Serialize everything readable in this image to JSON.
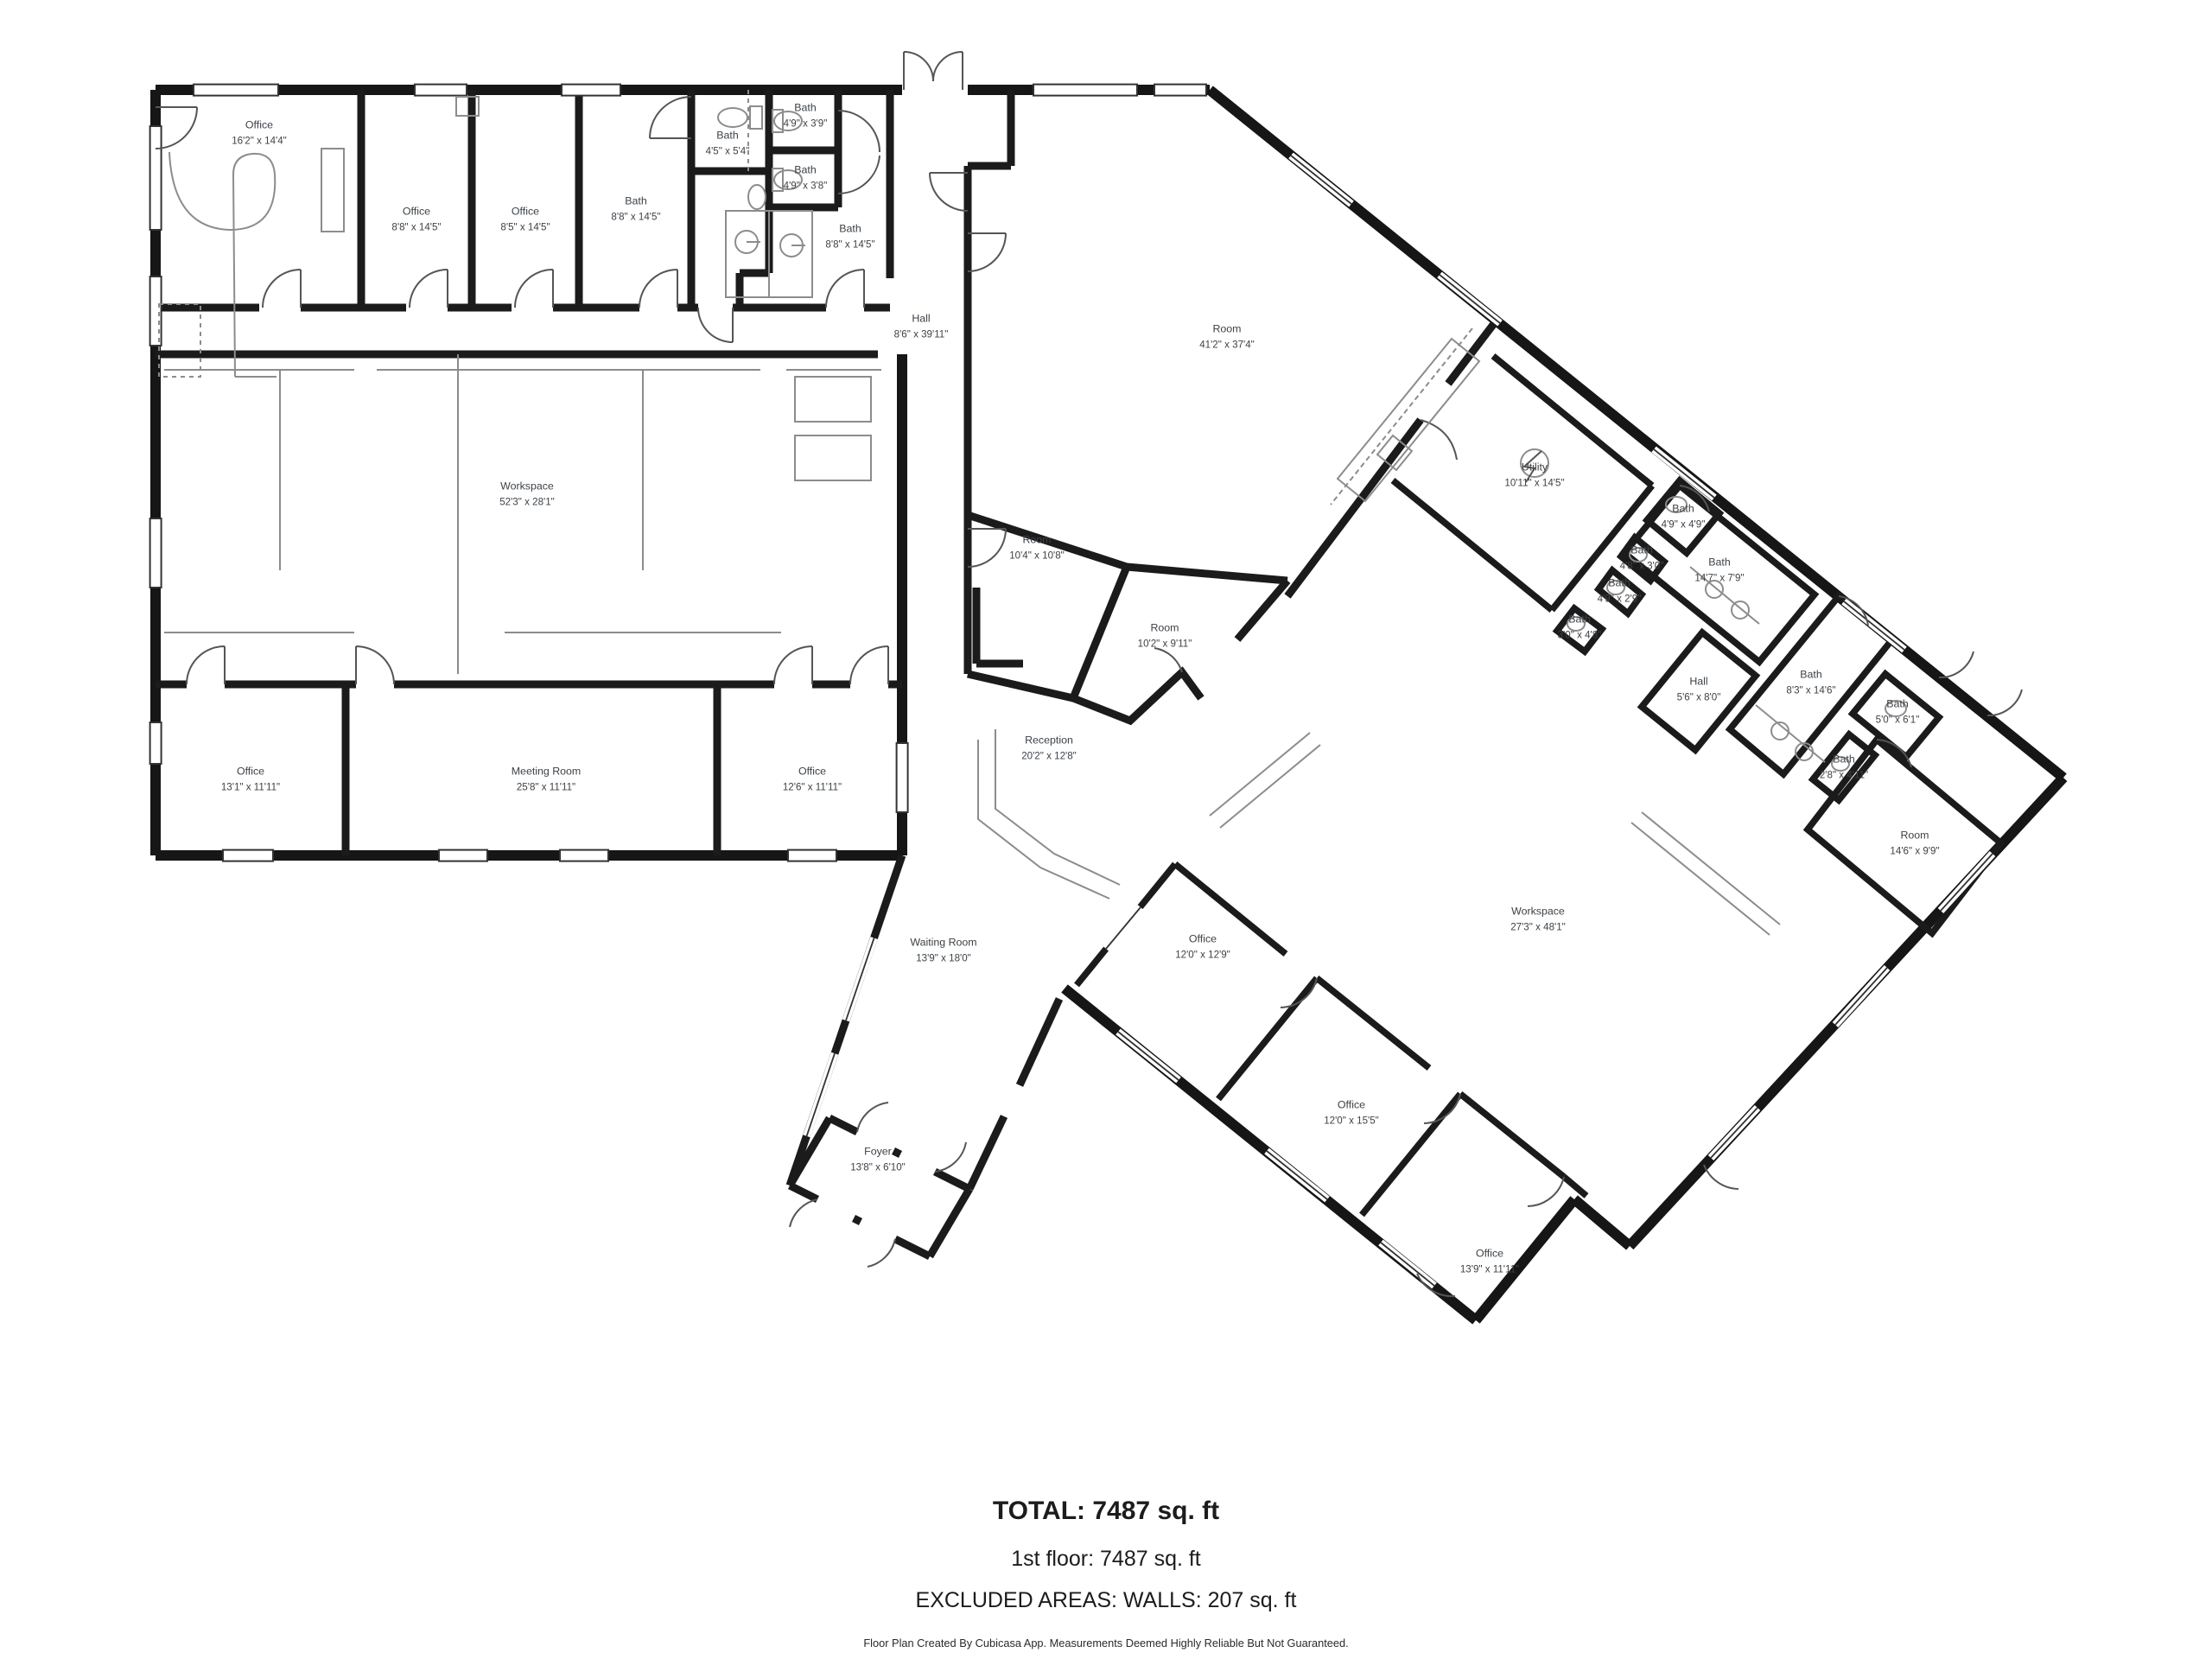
{
  "plan": {
    "type": "floor-plan",
    "source_app_note": "Floor Plan Created By Cubicasa App. Measurements Deemed Highly Reliable But Not Guaranteed.",
    "totals": {
      "total": "TOTAL: 7487 sq. ft",
      "first_floor": "1st floor: 7487 sq. ft",
      "excluded": "EXCLUDED AREAS: WALLS: 207 sq. ft"
    },
    "colors": {
      "walls": "#161616",
      "fixtures": "#8c8c8c",
      "label_text": "#3d4247",
      "background": "#ffffff"
    }
  },
  "rooms": [
    {
      "name": "Office",
      "dims": "16'2\" x 14'4\""
    },
    {
      "name": "Office",
      "dims": "8'8\" x 14'5\""
    },
    {
      "name": "Office",
      "dims": "8'5\" x 14'5\""
    },
    {
      "name": "Bath",
      "dims": "8'8\" x 14'5\""
    },
    {
      "name": "Bath",
      "dims": "4'5\" x 5'4\""
    },
    {
      "name": "Bath",
      "dims": "4'9\" x 3'9\""
    },
    {
      "name": "Bath",
      "dims": "4'9\" x 3'8\""
    },
    {
      "name": "Bath",
      "dims": "8'8\" x 14'5\""
    },
    {
      "name": "Hall",
      "dims": "8'6\" x 39'11\""
    },
    {
      "name": "Room",
      "dims": "41'2\" x 37'4\""
    },
    {
      "name": "Workspace",
      "dims": "52'3\" x 28'1\""
    },
    {
      "name": "Room",
      "dims": "10'4\" x 10'8\""
    },
    {
      "name": "Room",
      "dims": "10'2\" x 9'11\""
    },
    {
      "name": "Utility",
      "dims": "10'11\" x 14'5\""
    },
    {
      "name": "Bath",
      "dims": "4'9\" x 4'9\""
    },
    {
      "name": "Bath",
      "dims": "4'8\" x 3'0\""
    },
    {
      "name": "Bath",
      "dims": "4'9\" x 2'9\""
    },
    {
      "name": "Bath",
      "dims": "3'0\" x 4'8\""
    },
    {
      "name": "Bath",
      "dims": "14'7\" x 7'9\""
    },
    {
      "name": "Hall",
      "dims": "5'6\" x 8'0\""
    },
    {
      "name": "Bath",
      "dims": "8'3\" x 14'6\""
    },
    {
      "name": "Bath",
      "dims": "5'0\" x 6'1\""
    },
    {
      "name": "Bath",
      "dims": "2'8\" x 4'11\""
    },
    {
      "name": "Room",
      "dims": "14'6\" x 9'9\""
    },
    {
      "name": "Reception",
      "dims": "20'2\" x 12'8\""
    },
    {
      "name": "Office",
      "dims": "13'1\" x 11'11\""
    },
    {
      "name": "Meeting Room",
      "dims": "25'8\" x 11'11\""
    },
    {
      "name": "Office",
      "dims": "12'6\" x 11'11\""
    },
    {
      "name": "Waiting Room",
      "dims": "13'9\" x 18'0\""
    },
    {
      "name": "Office",
      "dims": "12'0\" x 12'9\""
    },
    {
      "name": "Workspace",
      "dims": "27'3\" x 48'1\""
    },
    {
      "name": "Foyer",
      "dims": "13'8\" x 6'10\""
    },
    {
      "name": "Office",
      "dims": "12'0\" x 15'5\""
    },
    {
      "name": "Office",
      "dims": "13'9\" x 11'11\""
    }
  ]
}
